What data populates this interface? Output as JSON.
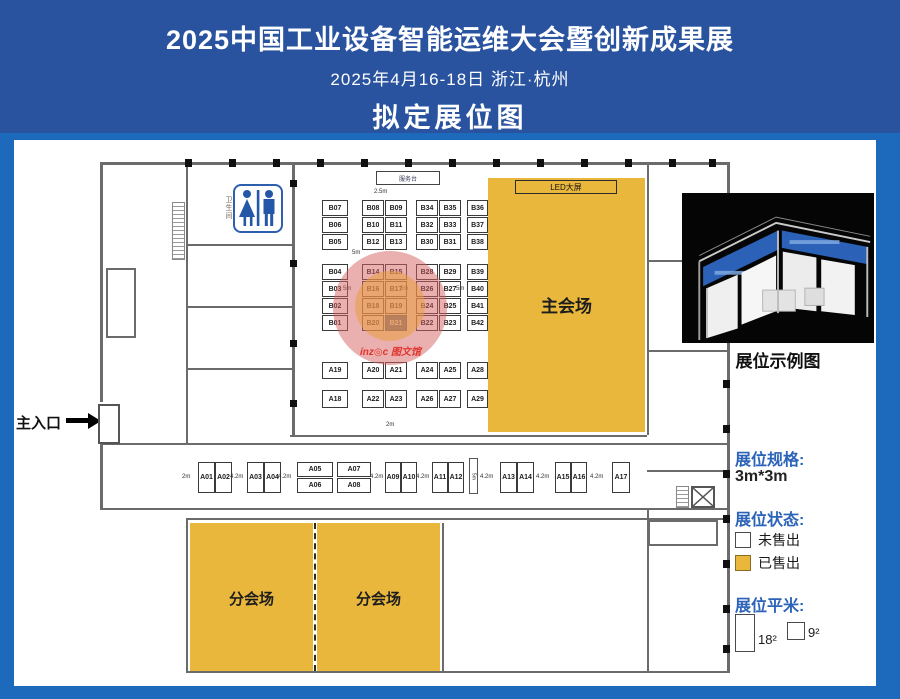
{
  "header": {
    "title": "2025中国工业设备智能运维大会暨创新成果展",
    "date_location": "2025年4月16-18日  浙江·杭州",
    "subtitle": "拟定展位图"
  },
  "colors": {
    "header_blue": "#2a539f",
    "frame_blue": "#1d69bc",
    "sold_yellow": "#e8b73c",
    "selected_blue": "#2456a8",
    "legend_blue": "#2b63b8",
    "highlight_red": "#d66060",
    "watermark_red": "#e0352c"
  },
  "floorplan": {
    "main_hall_label": "主会场",
    "sub_hall_label": "分会场",
    "led_label": "LED大屏",
    "service_desk_label": "服务台",
    "entrance_label": "主入口",
    "restroom_label": "卫生间",
    "watermark": "ínz◎c 图文馆",
    "booths": [
      [
        "B07",
        308,
        60,
        26,
        16
      ],
      [
        "B08",
        348,
        60,
        22,
        16
      ],
      [
        "B09",
        371,
        60,
        22,
        16
      ],
      [
        "B34",
        402,
        60,
        22,
        16
      ],
      [
        "B35",
        425,
        60,
        22,
        16
      ],
      [
        "B36",
        453,
        60,
        21,
        16
      ],
      [
        "B06",
        308,
        77,
        26,
        16
      ],
      [
        "B10",
        348,
        77,
        22,
        16
      ],
      [
        "B11",
        371,
        77,
        22,
        16
      ],
      [
        "B32",
        402,
        77,
        22,
        16
      ],
      [
        "B33",
        425,
        77,
        22,
        16
      ],
      [
        "B37",
        453,
        77,
        21,
        16
      ],
      [
        "B05",
        308,
        94,
        26,
        16
      ],
      [
        "B12",
        348,
        94,
        22,
        16
      ],
      [
        "B13",
        371,
        94,
        22,
        16
      ],
      [
        "B30",
        402,
        94,
        22,
        16
      ],
      [
        "B31",
        425,
        94,
        22,
        16
      ],
      [
        "B38",
        453,
        94,
        21,
        16
      ],
      [
        "B04",
        308,
        124,
        26,
        16
      ],
      [
        "B14",
        348,
        124,
        22,
        16
      ],
      [
        "B15",
        371,
        124,
        22,
        16
      ],
      [
        "B28",
        402,
        124,
        22,
        16
      ],
      [
        "B29",
        425,
        124,
        22,
        16
      ],
      [
        "B39",
        453,
        124,
        21,
        16
      ],
      [
        "B03",
        308,
        141,
        26,
        16
      ],
      [
        "B16",
        348,
        141,
        22,
        16
      ],
      [
        "B17",
        371,
        141,
        22,
        16
      ],
      [
        "B26",
        402,
        141,
        22,
        16
      ],
      [
        "B27",
        425,
        141,
        22,
        16
      ],
      [
        "B40",
        453,
        141,
        21,
        16
      ],
      [
        "B02",
        308,
        158,
        26,
        16
      ],
      [
        "B18",
        348,
        158,
        22,
        16
      ],
      [
        "B19",
        371,
        158,
        22,
        16
      ],
      [
        "B24",
        402,
        158,
        22,
        16
      ],
      [
        "B25",
        425,
        158,
        22,
        16
      ],
      [
        "B41",
        453,
        158,
        21,
        16
      ],
      [
        "B01",
        308,
        175,
        26,
        16
      ],
      [
        "B20",
        348,
        175,
        22,
        16
      ],
      [
        "B21",
        371,
        175,
        22,
        16,
        "sel"
      ],
      [
        "B22",
        402,
        175,
        22,
        16
      ],
      [
        "B23",
        425,
        175,
        22,
        16
      ],
      [
        "B42",
        453,
        175,
        21,
        16
      ],
      [
        "A19",
        308,
        222,
        26,
        17
      ],
      [
        "A20",
        348,
        222,
        22,
        17
      ],
      [
        "A21",
        371,
        222,
        22,
        17
      ],
      [
        "A24",
        402,
        222,
        22,
        17
      ],
      [
        "A25",
        425,
        222,
        22,
        17
      ],
      [
        "A28",
        453,
        222,
        21,
        17
      ],
      [
        "A18",
        308,
        250,
        26,
        18
      ],
      [
        "A22",
        348,
        250,
        22,
        18
      ],
      [
        "A23",
        371,
        250,
        22,
        18
      ],
      [
        "A26",
        402,
        250,
        22,
        18
      ],
      [
        "A27",
        425,
        250,
        22,
        18
      ],
      [
        "A29",
        453,
        250,
        21,
        18
      ],
      [
        "A01",
        184,
        322,
        17,
        31
      ],
      [
        "A02",
        201,
        322,
        17,
        31
      ],
      [
        "A03",
        233,
        322,
        17,
        31
      ],
      [
        "A04",
        250,
        322,
        17,
        31
      ],
      [
        "A05",
        283,
        322,
        36,
        15
      ],
      [
        "A06",
        283,
        338,
        36,
        15
      ],
      [
        "A07",
        323,
        322,
        34,
        15
      ],
      [
        "A08",
        323,
        338,
        34,
        15
      ],
      [
        "A09",
        371,
        322,
        16,
        31
      ],
      [
        "A10",
        387,
        322,
        16,
        31
      ],
      [
        "A11",
        418,
        322,
        16,
        31
      ],
      [
        "A12",
        434,
        322,
        16,
        31
      ],
      [
        "A13",
        486,
        322,
        17,
        31
      ],
      [
        "A14",
        503,
        322,
        17,
        31
      ],
      [
        "A15",
        541,
        322,
        16,
        31
      ],
      [
        "A16",
        557,
        322,
        16,
        31
      ],
      [
        "A17",
        598,
        322,
        18,
        31
      ]
    ],
    "aisle_labels": [
      [
        "2.5m",
        360,
        49
      ],
      [
        "5m",
        338,
        110
      ],
      [
        "5m",
        329,
        146
      ],
      [
        "5m",
        386,
        146
      ],
      [
        "5m",
        442,
        146
      ],
      [
        "2m",
        372,
        282
      ],
      [
        "2m",
        168,
        334
      ],
      [
        "4.2m",
        216,
        334
      ],
      [
        "4.2m",
        264,
        334
      ],
      [
        "4.2m",
        356,
        334
      ],
      [
        "4.2m",
        402,
        334
      ],
      [
        "4.2m",
        466,
        334
      ],
      [
        "4.2m",
        522,
        334
      ],
      [
        "4.2m",
        576,
        334
      ]
    ],
    "aisle_label_vertical": "5m"
  },
  "example": {
    "caption": "展位示例图"
  },
  "legend": {
    "spec_title": "展位规格:",
    "spec_value": "3m*3m",
    "status_title": "展位状态:",
    "status_items": [
      {
        "label": "未售出"
      },
      {
        "label": "已售出"
      }
    ],
    "size_title": "展位平米:",
    "size_items": [
      {
        "label": "18²"
      },
      {
        "label": "9²"
      }
    ]
  }
}
